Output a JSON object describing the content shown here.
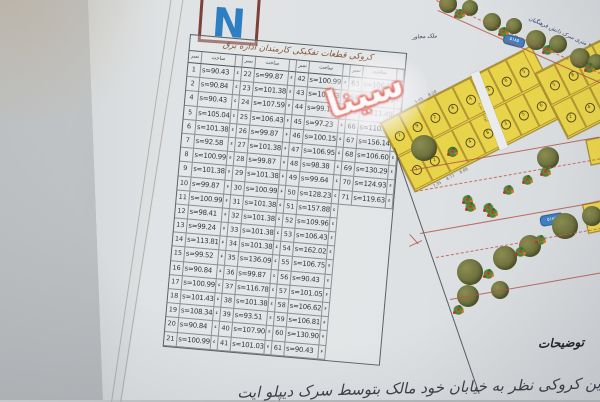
{
  "north": {
    "label": "N"
  },
  "table": {
    "title": "کروکی قطعات تفکیکی کارمندان اداره برق",
    "col_headers": {
      "num": "نمبر",
      "area": "ساحت"
    },
    "row_mark": "ء",
    "groups": [
      {
        "rows": [
          {
            "n": "1",
            "s": "s=90.43"
          },
          {
            "n": "2",
            "s": "s=90.84"
          },
          {
            "n": "4",
            "s": "s=90.43"
          },
          {
            "n": "5",
            "s": "s=105.04"
          },
          {
            "n": "6",
            "s": "s=101.38"
          },
          {
            "n": "7",
            "s": "s=92.58"
          },
          {
            "n": "8",
            "s": "s=100.99"
          },
          {
            "n": "9",
            "s": "s=101.38"
          },
          {
            "n": "10",
            "s": "s=99.87"
          },
          {
            "n": "11",
            "s": "s=100.99"
          },
          {
            "n": "12",
            "s": "s=98.41"
          },
          {
            "n": "13",
            "s": "s=99.24"
          },
          {
            "n": "14",
            "s": "s=113.81"
          },
          {
            "n": "15",
            "s": "s=99.52"
          },
          {
            "n": "16",
            "s": "s=90.84"
          },
          {
            "n": "17",
            "s": "s=100.99"
          },
          {
            "n": "18",
            "s": "s=101.43"
          },
          {
            "n": "19",
            "s": "s=108.34"
          },
          {
            "n": "20",
            "s": "s=90.84"
          },
          {
            "n": "21",
            "s": "s=100.99"
          }
        ]
      },
      {
        "rows": [
          {
            "n": "22",
            "s": "s=99.87"
          },
          {
            "n": "23",
            "s": "s=101.38"
          },
          {
            "n": "24",
            "s": "s=107.59"
          },
          {
            "n": "25",
            "s": "s=106.43"
          },
          {
            "n": "26",
            "s": "s=99.87"
          },
          {
            "n": "27",
            "s": "s=101.38"
          },
          {
            "n": "28",
            "s": "s=99.87"
          },
          {
            "n": "29",
            "s": "s=101.38"
          },
          {
            "n": "30",
            "s": "s=100.99"
          },
          {
            "n": "31",
            "s": "s=101.38"
          },
          {
            "n": "32",
            "s": "s=101.38"
          },
          {
            "n": "33",
            "s": "s=101.38"
          },
          {
            "n": "34",
            "s": "s=101.38"
          },
          {
            "n": "35",
            "s": "s=136.09"
          },
          {
            "n": "36",
            "s": "s=99.87"
          },
          {
            "n": "37",
            "s": "s=116.78"
          },
          {
            "n": "38",
            "s": "s=101.38"
          },
          {
            "n": "39",
            "s": "s=93.51"
          },
          {
            "n": "40",
            "s": "s=107.90"
          },
          {
            "n": "41",
            "s": "s=101.03"
          }
        ]
      },
      {
        "rows": [
          {
            "n": "42",
            "s": "s=100.99"
          },
          {
            "n": "43",
            "s": "s=101.43"
          },
          {
            "n": "44",
            "s": "s=99.17"
          },
          {
            "n": "45",
            "s": "s=97.23"
          },
          {
            "n": "46",
            "s": "s=100.15"
          },
          {
            "n": "47",
            "s": "s=106.95"
          },
          {
            "n": "48",
            "s": "s=98.38"
          },
          {
            "n": "49",
            "s": "s=99.64"
          },
          {
            "n": "50",
            "s": "s=128.23"
          },
          {
            "n": "51",
            "s": "s=157.88"
          },
          {
            "n": "52",
            "s": "s=109.96"
          },
          {
            "n": "53",
            "s": "s=106.43"
          },
          {
            "n": "54",
            "s": "s=162.02"
          },
          {
            "n": "55",
            "s": "s=106.75"
          },
          {
            "n": "56",
            "s": "s=90.43"
          },
          {
            "n": "57",
            "s": "s=101.05"
          },
          {
            "n": "58",
            "s": "s=106.62"
          },
          {
            "n": "59",
            "s": "s=106.81"
          },
          {
            "n": "60",
            "s": "s=130.90"
          },
          {
            "n": "61",
            "s": "s=90.43"
          }
        ]
      },
      {
        "rows": [
          {
            "n": "63",
            "s": "s=106.17"
          },
          {
            "n": "64",
            "s": "s=110.99"
          },
          {
            "n": "65",
            "s": "s=111.40"
          },
          {
            "n": "66",
            "s": "s=110.15"
          },
          {
            "n": "67",
            "s": "s=156.14"
          },
          {
            "n": "68",
            "s": "s=106.60"
          },
          {
            "n": "69",
            "s": "s=130.29"
          },
          {
            "n": "70",
            "s": "s=124.93"
          },
          {
            "n": "71",
            "s": "s=119.63"
          }
        ]
      }
    ]
  },
  "map": {
    "adjacent_label": "ملک مجاور",
    "street_label": "۲۴ متری سرک دانش فرهنگیان",
    "lane_label": "کوچه ۴ متره",
    "sign_top": "۵۱۸۵",
    "sign_bottom": "۵۱۸۵",
    "plot_numbers_left": [
      "7",
      "9",
      "2",
      "8",
      "4",
      "3",
      "6",
      "5",
      "1",
      "2",
      "9",
      "4",
      "8",
      "3",
      "5",
      "6"
    ],
    "plot_numbers_right": [
      "5",
      "8",
      "3",
      "9",
      "6",
      "2",
      "4",
      "7",
      "1",
      "8"
    ],
    "edge_dims": [
      "7.35",
      "8.77",
      "8.86",
      "5.45",
      "8.20"
    ],
    "edge_plot_numbers": [
      "34"
    ]
  },
  "notes": {
    "heading": "توضیحات",
    "line": "این کروکی نظر به خیابان خود مالک بتوسط سرک دیپلو ایت"
  },
  "watermark": {
    "text": "سینا"
  },
  "colors": {
    "plot_yellow": "#e8d44a",
    "road_red": "#b5564a",
    "sign_blue": "#3f7fc4",
    "north_blue": "#2d7fc2",
    "stamp_red": "#d23b30"
  }
}
